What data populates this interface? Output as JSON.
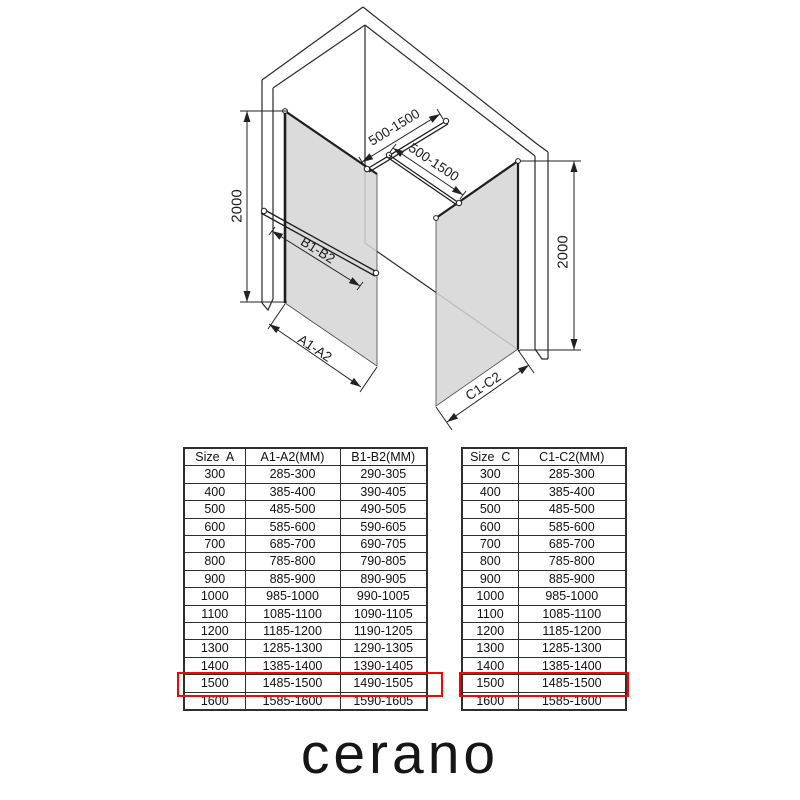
{
  "page": {
    "background": "#ffffff"
  },
  "diagram": {
    "height_label": "2000",
    "bar_length_label": "500-1500",
    "panel_a_label": "A1-A2",
    "bar_b_label": "B1-B2",
    "panel_c_label": "C1-C2",
    "glass_color": "#d5d5d5",
    "line_color": "#262626"
  },
  "tables": {
    "highlight_color": "#ff0000",
    "highlight_size": "1500",
    "left": {
      "headers": [
        "Size  A",
        "A1-A2(MM)",
        "B1-B2(MM)"
      ],
      "rows": [
        [
          "300",
          "285-300",
          "290-305"
        ],
        [
          "400",
          "385-400",
          "390-405"
        ],
        [
          "500",
          "485-500",
          "490-505"
        ],
        [
          "600",
          "585-600",
          "590-605"
        ],
        [
          "700",
          "685-700",
          "690-705"
        ],
        [
          "800",
          "785-800",
          "790-805"
        ],
        [
          "900",
          "885-900",
          "890-905"
        ],
        [
          "1000",
          "985-1000",
          "990-1005"
        ],
        [
          "1100",
          "1085-1100",
          "1090-1105"
        ],
        [
          "1200",
          "1185-1200",
          "1190-1205"
        ],
        [
          "1300",
          "1285-1300",
          "1290-1305"
        ],
        [
          "1400",
          "1385-1400",
          "1390-1405"
        ],
        [
          "1500",
          "1485-1500",
          "1490-1505"
        ],
        [
          "1600",
          "1585-1600",
          "1590-1605"
        ]
      ]
    },
    "right": {
      "headers": [
        "Size  C",
        "C1-C2(MM)"
      ],
      "rows": [
        [
          "300",
          "285-300"
        ],
        [
          "400",
          "385-400"
        ],
        [
          "500",
          "485-500"
        ],
        [
          "600",
          "585-600"
        ],
        [
          "700",
          "685-700"
        ],
        [
          "800",
          "785-800"
        ],
        [
          "900",
          "885-900"
        ],
        [
          "1000",
          "985-1000"
        ],
        [
          "1100",
          "1085-1100"
        ],
        [
          "1200",
          "1185-1200"
        ],
        [
          "1300",
          "1285-1300"
        ],
        [
          "1400",
          "1385-1400"
        ],
        [
          "1500",
          "1485-1500"
        ],
        [
          "1600",
          "1585-1600"
        ]
      ]
    }
  },
  "footer": {
    "brand": "cerano"
  }
}
